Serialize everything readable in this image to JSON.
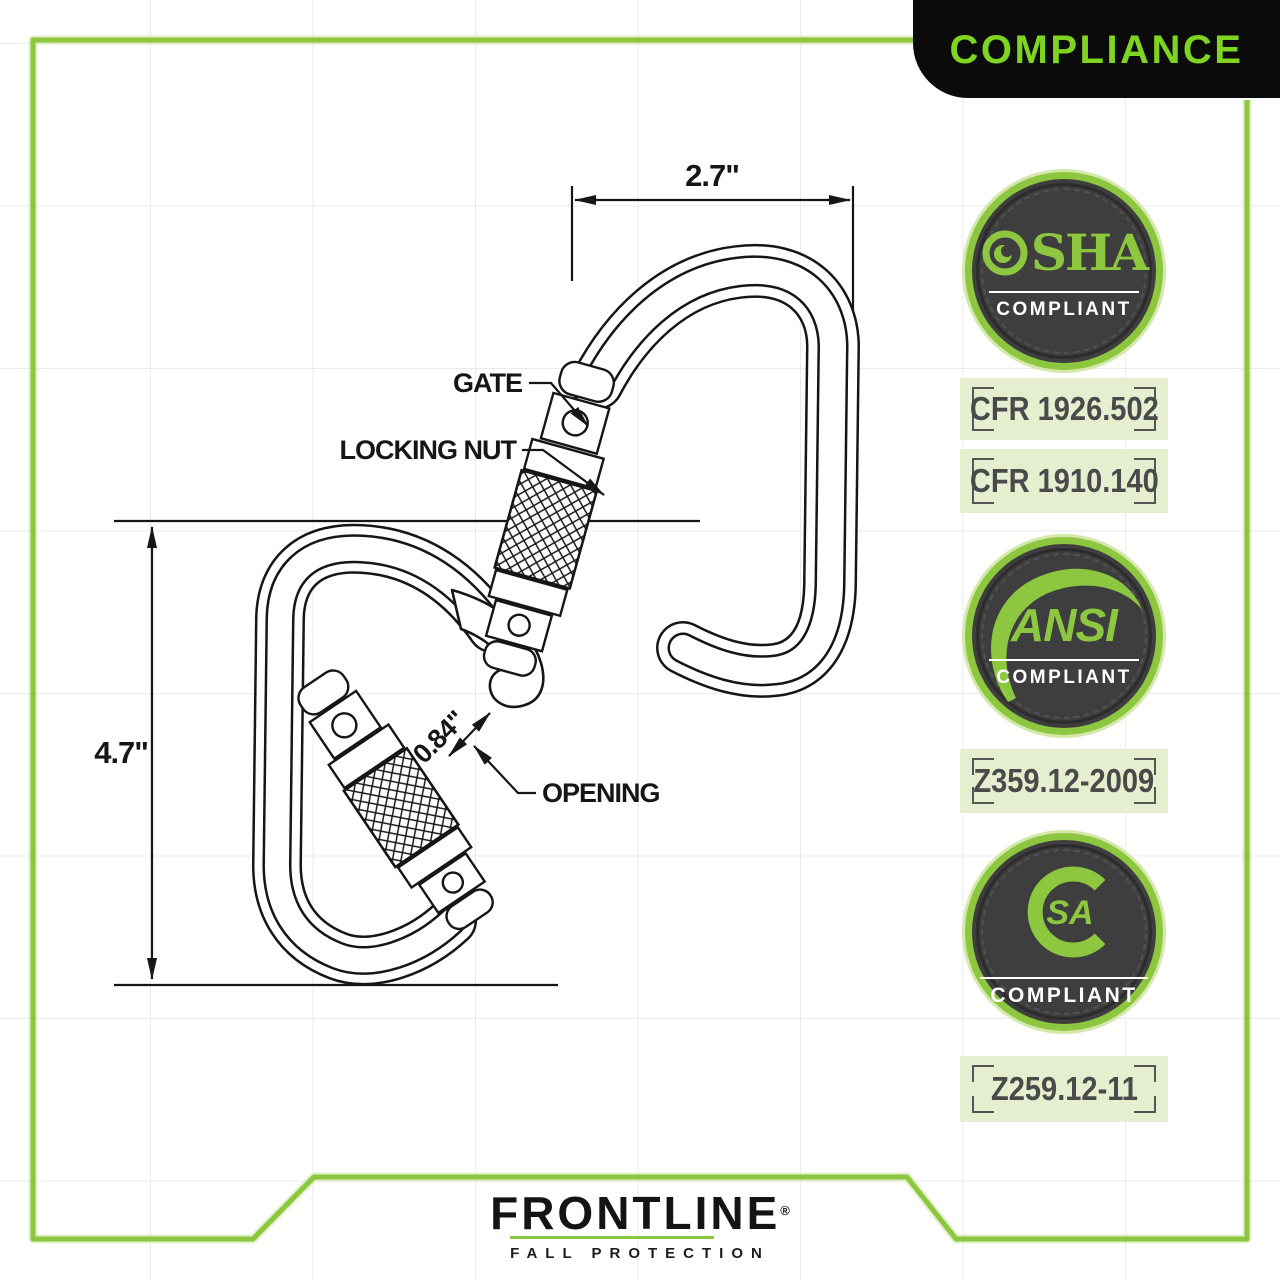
{
  "banner": {
    "label": "COMPLIANCE"
  },
  "drawing": {
    "width_dim": "2.7\"",
    "height_dim": "4.7\"",
    "opening_dim": "0.84\"",
    "gate_label": "GATE",
    "locking_nut_label": "LOCKING NUT",
    "opening_label": "OPENING"
  },
  "badges": {
    "osha": {
      "wordmark_after_o": "SHA",
      "compliant": "COMPLIANT"
    },
    "ansi": {
      "wordmark": "ANSI",
      "compliant": "COMPLIANT"
    },
    "csa": {
      "monogram_inner": "SA",
      "compliant": "COMPLIANT"
    }
  },
  "plates": [
    "CFR 1926.502",
    "CFR 1910.140",
    "Z359.12-2009",
    "Z259.12-11"
  ],
  "logo": {
    "brand": "FRONTLINE",
    "registered": "®",
    "tagline": "FALL PROTECTION"
  },
  "colors": {
    "accent_green": "#8dc63f",
    "banner_text_green": "#7fd41f",
    "badge_dark": "#3e3e3e",
    "plate_background": "#e5efd0",
    "line_ink": "#161616"
  }
}
